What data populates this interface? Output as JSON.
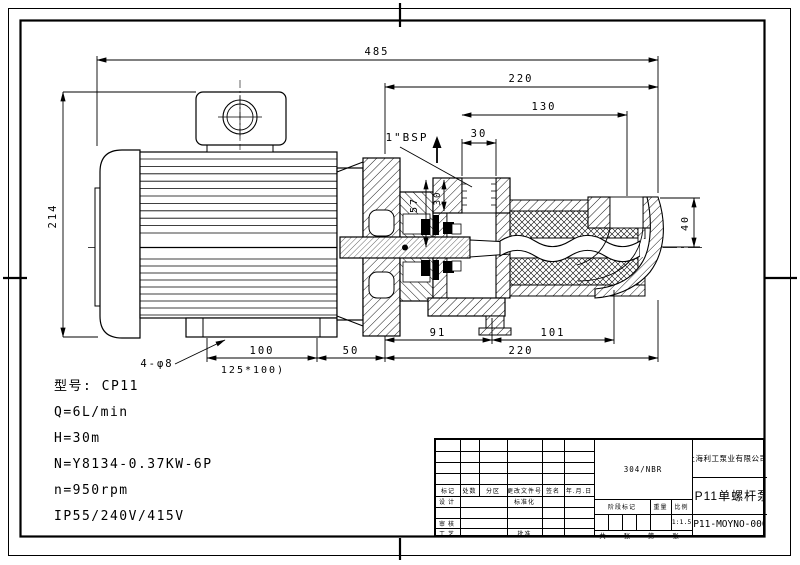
{
  "page": {
    "background": "#ffffff",
    "line_color": "#000000"
  },
  "spec_block": {
    "lines": [
      "型号: CP11",
      "Q=6L/min",
      "H=30m",
      "N=Y8134-0.37KW-6P",
      "n=950rpm",
      "IP55/240V/415V"
    ]
  },
  "drawing": {
    "dims": {
      "overall_length": "485",
      "pump_length_top": "220",
      "stator_length": "130",
      "port_offset": "30",
      "port_label": "1\"BSP",
      "port_height": "57",
      "port_depth": "30",
      "motor_height": "214",
      "outlet_size": "40",
      "seal_length": "91",
      "rotor_length": "101",
      "pump_length_bottom": "220",
      "foot_spacing": "100",
      "foot_to_flange": "50",
      "base_size": "125*100)",
      "mount_holes": "4-φ8"
    }
  },
  "title_block": {
    "material": "304/NBR",
    "company": "上海利工泵业有限公司",
    "product_title": "CP11单螺杆泵",
    "drawing_number": "CP11-MOYNO-000",
    "scale_value": "1:1.5",
    "labels": {
      "mark": "标记",
      "count": "处数",
      "zone": "分区",
      "change_file": "更改文件号",
      "signature": "签名",
      "date": "年.月.日",
      "design": "设计",
      "standardize": "标准化",
      "review": "审核",
      "process": "工艺",
      "approve": "批准",
      "stage_mark": "阶段标记",
      "weight": "重量",
      "scale": "比例",
      "sheet": "共 张 第 张"
    }
  }
}
